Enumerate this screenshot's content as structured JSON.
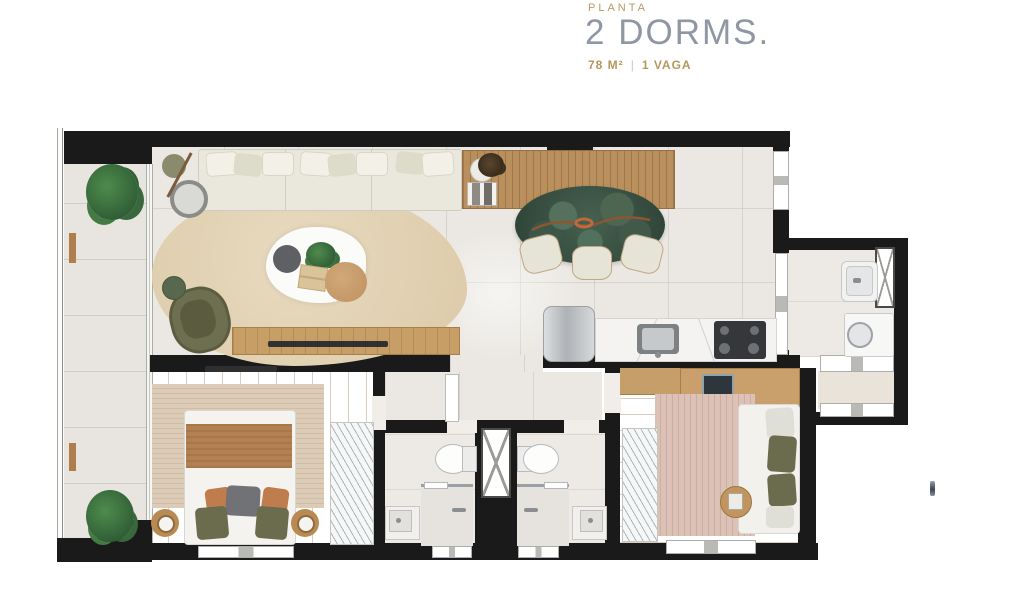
{
  "header": {
    "eyebrow": "PLANTA",
    "title": "2 DORMS.",
    "area": "78 M²",
    "separator": "|",
    "parking": "1 VAGA"
  },
  "palette": {
    "accent_gold": "#B5985C",
    "title_gray": "#8F97A4",
    "wall_black": "#1A1A1A",
    "tile_floor": "#EBE8E3",
    "wood_floor": "#C9A06B",
    "living_rug_beige": "#E4D5B9",
    "bedroom2_rug_rose": "#D8BFB3",
    "dining_table_green": "#3E5847",
    "plant_green": "#3F7A45",
    "sofa_cream": "#EDEBDF",
    "blanket_brown": "#B28052",
    "olive_upholstery": "#6B6C4E"
  },
  "floorplan": {
    "rooms": [
      {
        "name": "balcony",
        "furniture": [
          "plant",
          "plant",
          "wood-deck-posts",
          "glass-railing"
        ]
      },
      {
        "name": "living-room",
        "furniture": [
          "sofa",
          "floor-lamp",
          "armchair",
          "side-table",
          "coffee-table-set",
          "rug",
          "tv-console"
        ]
      },
      {
        "name": "dining-area",
        "furniture": [
          "sideboard",
          "oval-dining-table",
          "three-chairs"
        ]
      },
      {
        "name": "kitchen",
        "furniture": [
          "refrigerator",
          "marble-counter",
          "sink",
          "cooktop"
        ]
      },
      {
        "name": "laundry-area",
        "furniture": [
          "washtub",
          "washing-machine",
          "duct-shaft"
        ]
      },
      {
        "name": "entry-hall",
        "furniture": [
          "door-thresholds"
        ]
      },
      {
        "name": "bathroom-1",
        "furniture": [
          "toilet",
          "shower",
          "sink-counter",
          "window"
        ]
      },
      {
        "name": "bathroom-2",
        "furniture": [
          "toilet",
          "shower",
          "sink-counter",
          "window"
        ]
      },
      {
        "name": "master-bedroom",
        "furniture": [
          "double-bed",
          "nightstand",
          "nightstand",
          "striped-rug",
          "wardrobe",
          "tv"
        ]
      },
      {
        "name": "bedroom-2",
        "furniture": [
          "bed",
          "desk",
          "monitor",
          "desk-chair",
          "striped-rug",
          "wardrobe",
          "side-table"
        ]
      }
    ]
  }
}
